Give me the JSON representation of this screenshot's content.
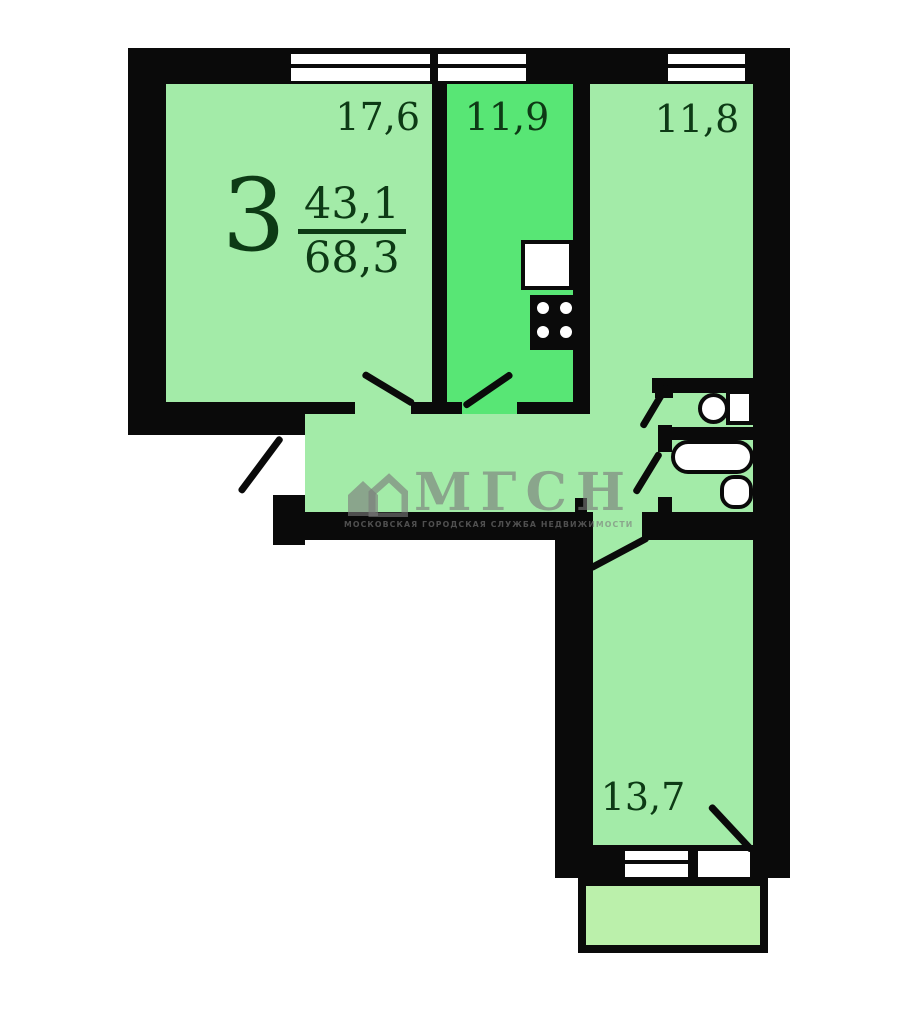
{
  "floorplan": {
    "apartment": {
      "rooms_count": "3",
      "living_area": "43,1",
      "total_area": "68,3"
    },
    "rooms": [
      {
        "name": "living-room",
        "area": "17,6"
      },
      {
        "name": "kitchen",
        "area": "11,9"
      },
      {
        "name": "bedroom-top-right",
        "area": "11,8"
      },
      {
        "name": "bedroom-bottom-right",
        "area": "13,7"
      }
    ],
    "colors": {
      "room_fill": "#a3eba8",
      "kitchen_fill": "#58e675",
      "balcony_fill": "#bbf0ab",
      "wall": "#0a0a0a",
      "label_text": "#0d3a15"
    }
  },
  "watermark": {
    "logo_text": "МГСН",
    "subtitle": "МОСКОВСКАЯ ГОРОДСКАЯ СЛУЖБА НЕДВИЖИМОСТИ"
  }
}
